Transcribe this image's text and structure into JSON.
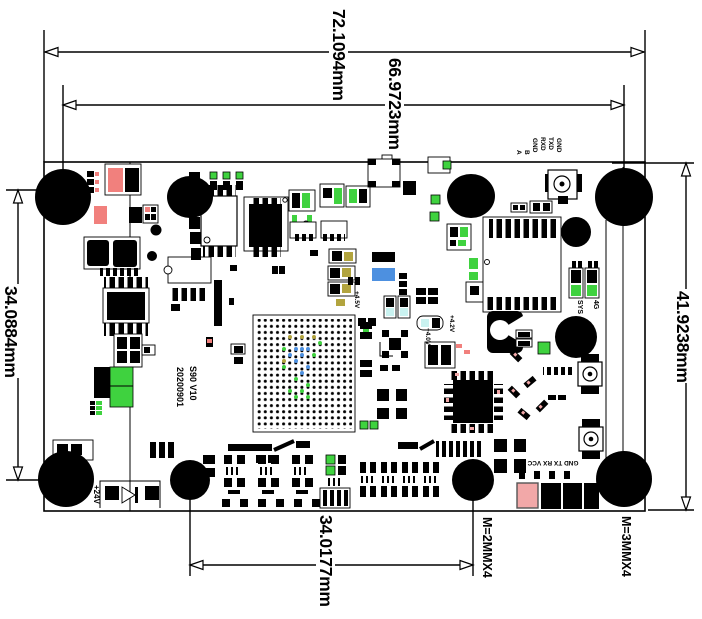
{
  "drawing": {
    "type": "PCB mechanical dimension drawing",
    "dimensions": {
      "board_width": "72.1094mm",
      "hole_span_width": "66.9723mm",
      "hole_span_left": "34.0884mm",
      "board_height": "41.9238mm",
      "hole_span_bottom": "34.0177mm",
      "mount_spec_small": "M=2MMX4",
      "mount_spec_large": "M=3MMX4"
    },
    "silkscreen": {
      "top_pins": [
        "A",
        "B",
        "GND",
        "RXD",
        "TXD",
        "GND"
      ],
      "bottom_pins": "GND TX RX VCC",
      "led_labels": [
        "SYS",
        "4G"
      ],
      "power_input": "+24V",
      "model": "S90 V10",
      "date_code": "20200901",
      "volt_1": "+4.5V",
      "volt_2": "+4.2V",
      "volt_3": "+4.0V"
    },
    "colors": {
      "line": "#000000",
      "board_fill": "#ffffff",
      "pad_red": "#f1807d",
      "pad_pink": "#f2a8a8",
      "pad_green": "#3fd23f",
      "pad_blue": "#4d90e0",
      "pad_cyan": "#c9f2f0",
      "pad_olive": "#b2a43e"
    }
  }
}
